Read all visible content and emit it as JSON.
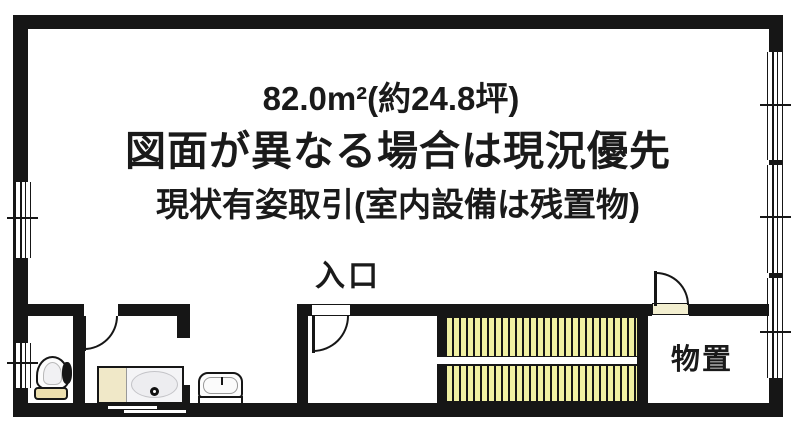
{
  "notices": {
    "area": "82.0m²(約24.8坪)",
    "line2": "図面が異なる場合は現況優先",
    "line3": "現状有姿取引(室内設備は残置物)"
  },
  "labels": {
    "entrance": "入口",
    "storage": "物置"
  },
  "colors": {
    "wall": "#161616",
    "background": "#ffffff",
    "stair_tread": "#f0f0a2",
    "fixture_cream": "#ecdfae",
    "vanity_cream": "#f0e8c8",
    "door_sill": "#f3efd0",
    "ink": "#1a1a1a"
  },
  "fixtures": [
    {
      "name": "toilet",
      "type": "toilet"
    },
    {
      "name": "vanity-sink",
      "type": "sink-counter"
    },
    {
      "name": "washbasin",
      "type": "basin"
    },
    {
      "name": "staircase",
      "type": "u-turn-stairs"
    },
    {
      "name": "storage-room",
      "type": "room"
    }
  ]
}
